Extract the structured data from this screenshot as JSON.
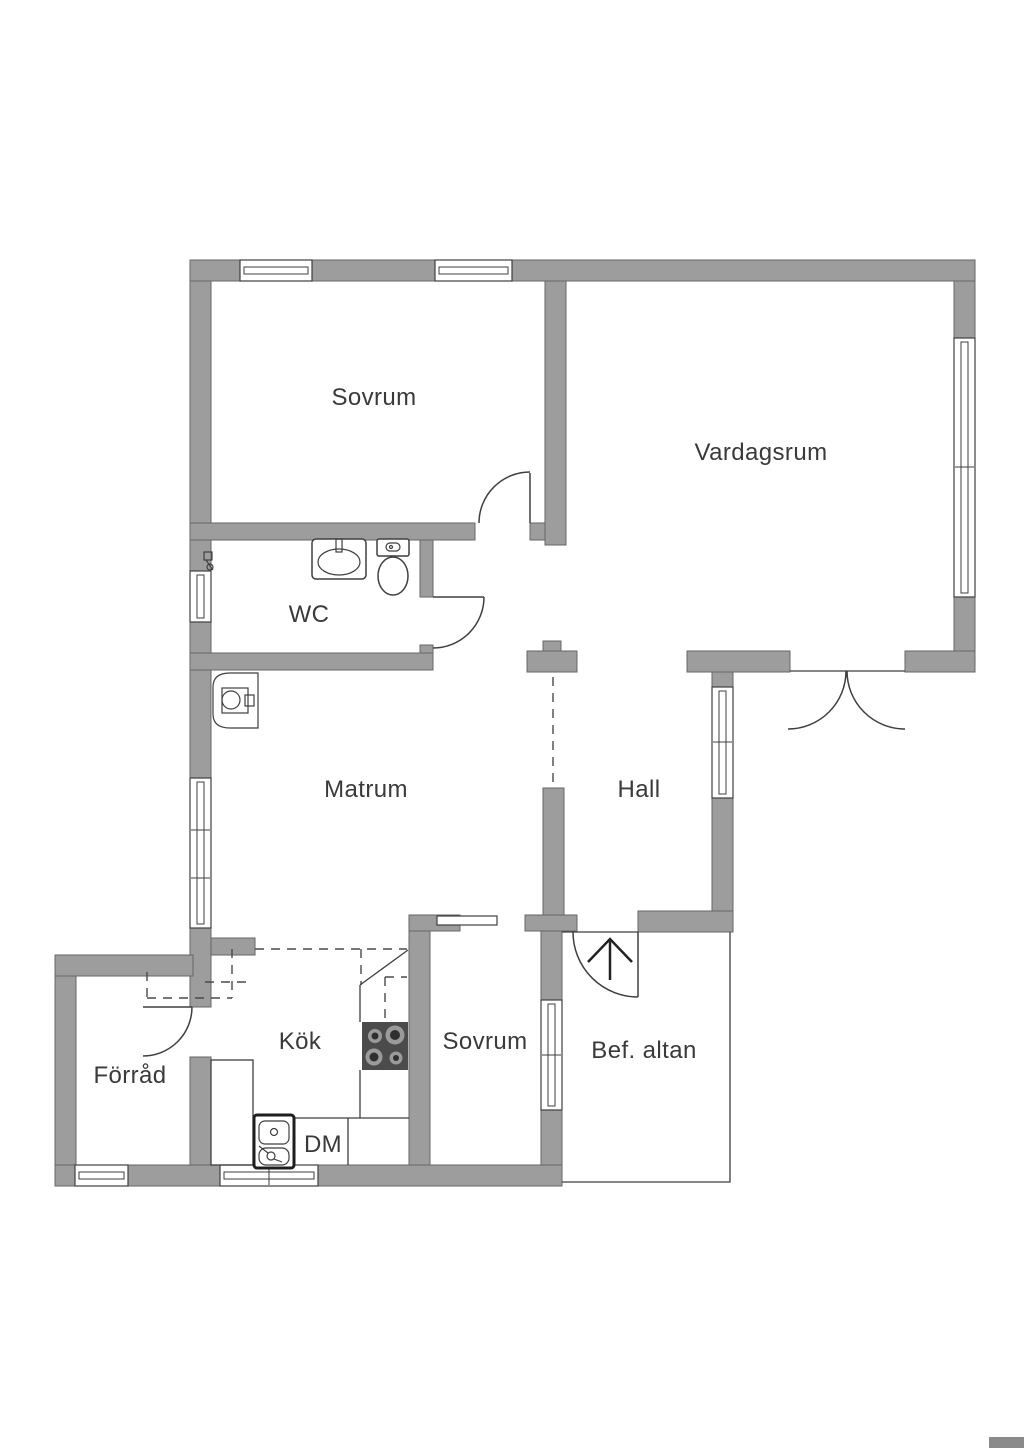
{
  "floorplan": {
    "type": "residential-floor-plan",
    "rooms": [
      {
        "id": "sovrum1",
        "label": "Sovrum"
      },
      {
        "id": "vardagsrum",
        "label": "Vardagsrum"
      },
      {
        "id": "wc",
        "label": "WC"
      },
      {
        "id": "matrum",
        "label": "Matrum"
      },
      {
        "id": "hall",
        "label": "Hall"
      },
      {
        "id": "kok",
        "label": "Kök"
      },
      {
        "id": "sovrum2",
        "label": "Sovrum"
      },
      {
        "id": "forrad",
        "label": "Förråd"
      },
      {
        "id": "bef_altan",
        "label": "Bef. altan"
      }
    ],
    "appliances": {
      "dishwasher_label": "DM"
    },
    "icons": [
      "washbasin-icon",
      "toilet-icon",
      "water-heater-icon",
      "valve-icon",
      "stove-icon",
      "kitchen-sink-icon",
      "entrance-arrow-icon",
      "sliding-door-icon"
    ],
    "colors": {
      "wall_fill": "#9d9d9d",
      "wall_stroke": "#666666",
      "line_color": "#3f3f3f",
      "dash_color": "#4a4a4a",
      "text_color": "#3a3a3a",
      "stove_fill": "#4b4b4b",
      "burner_ring": "#9a9a9a",
      "burner_center": "#2f2f2f",
      "watermark": "#8a8a8a"
    }
  }
}
